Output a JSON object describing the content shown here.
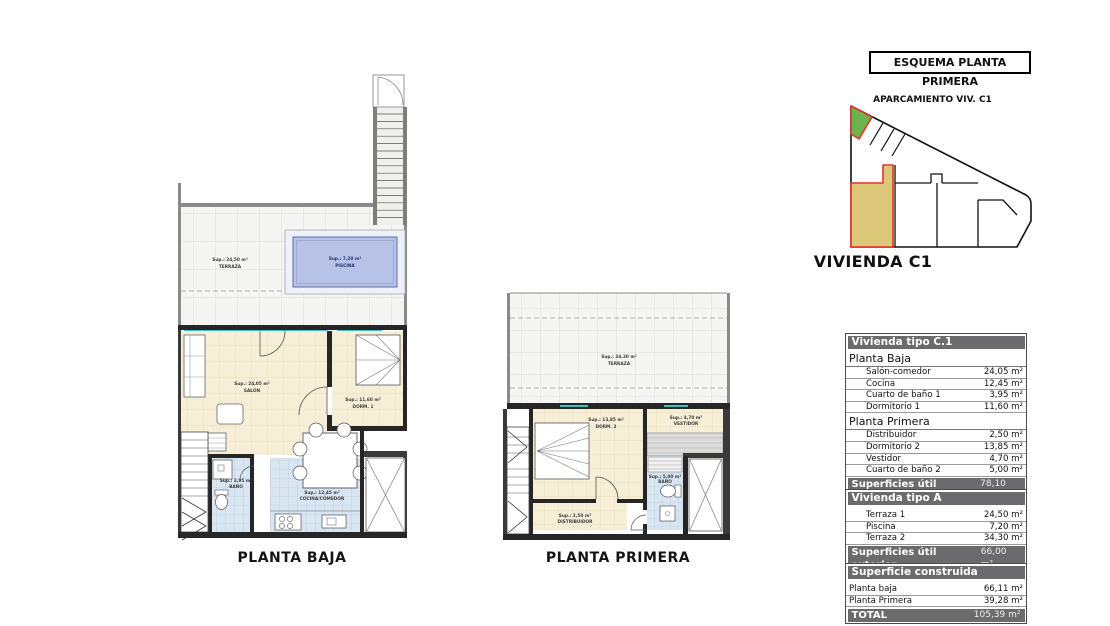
{
  "plans": {
    "planta_baja": {
      "title": "PLANTA BAJA",
      "labels": {
        "terraza": {
          "l1": "Sup.: 24,50 m²",
          "l2": "TERRAZA"
        },
        "piscina": {
          "l1": "Sup.: 7,20 m²",
          "l2": "PISCINA"
        },
        "salon": {
          "l1": "Sup.: 24,05 m²",
          "l2": "SALÓN"
        },
        "dorm1": {
          "l1": "Sup.: 11,60 m²",
          "l2": "DORM. 1"
        },
        "bano": {
          "l1": "Sup.: 3,95 m²",
          "l2": "BAÑO"
        },
        "cocina": {
          "l1": "Sup.: 12,45 m²",
          "l2": "COCINA/COMEDOR"
        }
      }
    },
    "planta_primera": {
      "title": "PLANTA PRIMERA",
      "labels": {
        "terraza": {
          "l1": "Sup.: 34,30 m²",
          "l2": "TERRAZA"
        },
        "dorm2": {
          "l1": "Sup.: 13,85 m²",
          "l2": "DORM. 2"
        },
        "vestidor": {
          "l1": "Sup.: 4,70 m²",
          "l2": "VESTIDOR"
        },
        "bano": {
          "l1": "Sup.: 5,00 m²",
          "l2": "BAÑO"
        },
        "distribuidor": {
          "l1": "Sup.: 2,50 m²",
          "l2": "DISTRIBUIDOR"
        }
      }
    }
  },
  "esquema": {
    "box_title": "ESQUEMA PLANTA PRIMERA",
    "parking_label": "APARCAMIENTO VIV. C1",
    "vivienda_label": "VIVIENDA C1"
  },
  "colors": {
    "highlight_red": "#e63322",
    "parking_green": "#6cb34e",
    "unit_yellow": "#dcc878",
    "table_header_gray": "#6b6b6d",
    "floor_cream": "#f6eed6",
    "tile_blue": "#d9e6f2",
    "pool_blue": "#b7c2e6",
    "glass_teal": "#45bdbd"
  },
  "tables": {
    "interior": {
      "header": "Vivienda tipo C.1",
      "sections": [
        {
          "title": "Planta Baja",
          "rows": [
            {
              "label": "Salón-comedor",
              "value": "24,05 m²"
            },
            {
              "label": "Cocina",
              "value": "12,45 m²"
            },
            {
              "label": "Cuarto de baño 1",
              "value": "3,95 m²"
            },
            {
              "label": "Dormitorio 1",
              "value": "11,60 m²"
            }
          ]
        },
        {
          "title": "Planta Primera",
          "rows": [
            {
              "label": "Distribuidor",
              "value": "2,50 m²"
            },
            {
              "label": "Dormitorio 2",
              "value": "13,85 m²"
            },
            {
              "label": "Vestidor",
              "value": "4,70 m²"
            },
            {
              "label": "Cuarto de baño 2",
              "value": "5,00 m²"
            }
          ]
        }
      ],
      "footer": {
        "label": "Superficies útil interior",
        "value": "78,10 m²"
      }
    },
    "exterior": {
      "header": "Vivienda tipo A",
      "rows": [
        {
          "label": "Terraza 1",
          "value": "24,50 m²"
        },
        {
          "label": "Piscina",
          "value": "7,20 m²"
        },
        {
          "label": "Terraza 2",
          "value": "34,30 m²"
        }
      ],
      "footer": {
        "label": "Superficies útil exterior",
        "value": "66,00 m²"
      }
    },
    "construida": {
      "header": "Superficie construida",
      "rows": [
        {
          "label": "Planta baja",
          "value": "66,11 m²"
        },
        {
          "label": "Planta Primera",
          "value": "39,28 m²"
        }
      ],
      "footer": {
        "label": "TOTAL",
        "value": "105,39 m²"
      }
    }
  }
}
